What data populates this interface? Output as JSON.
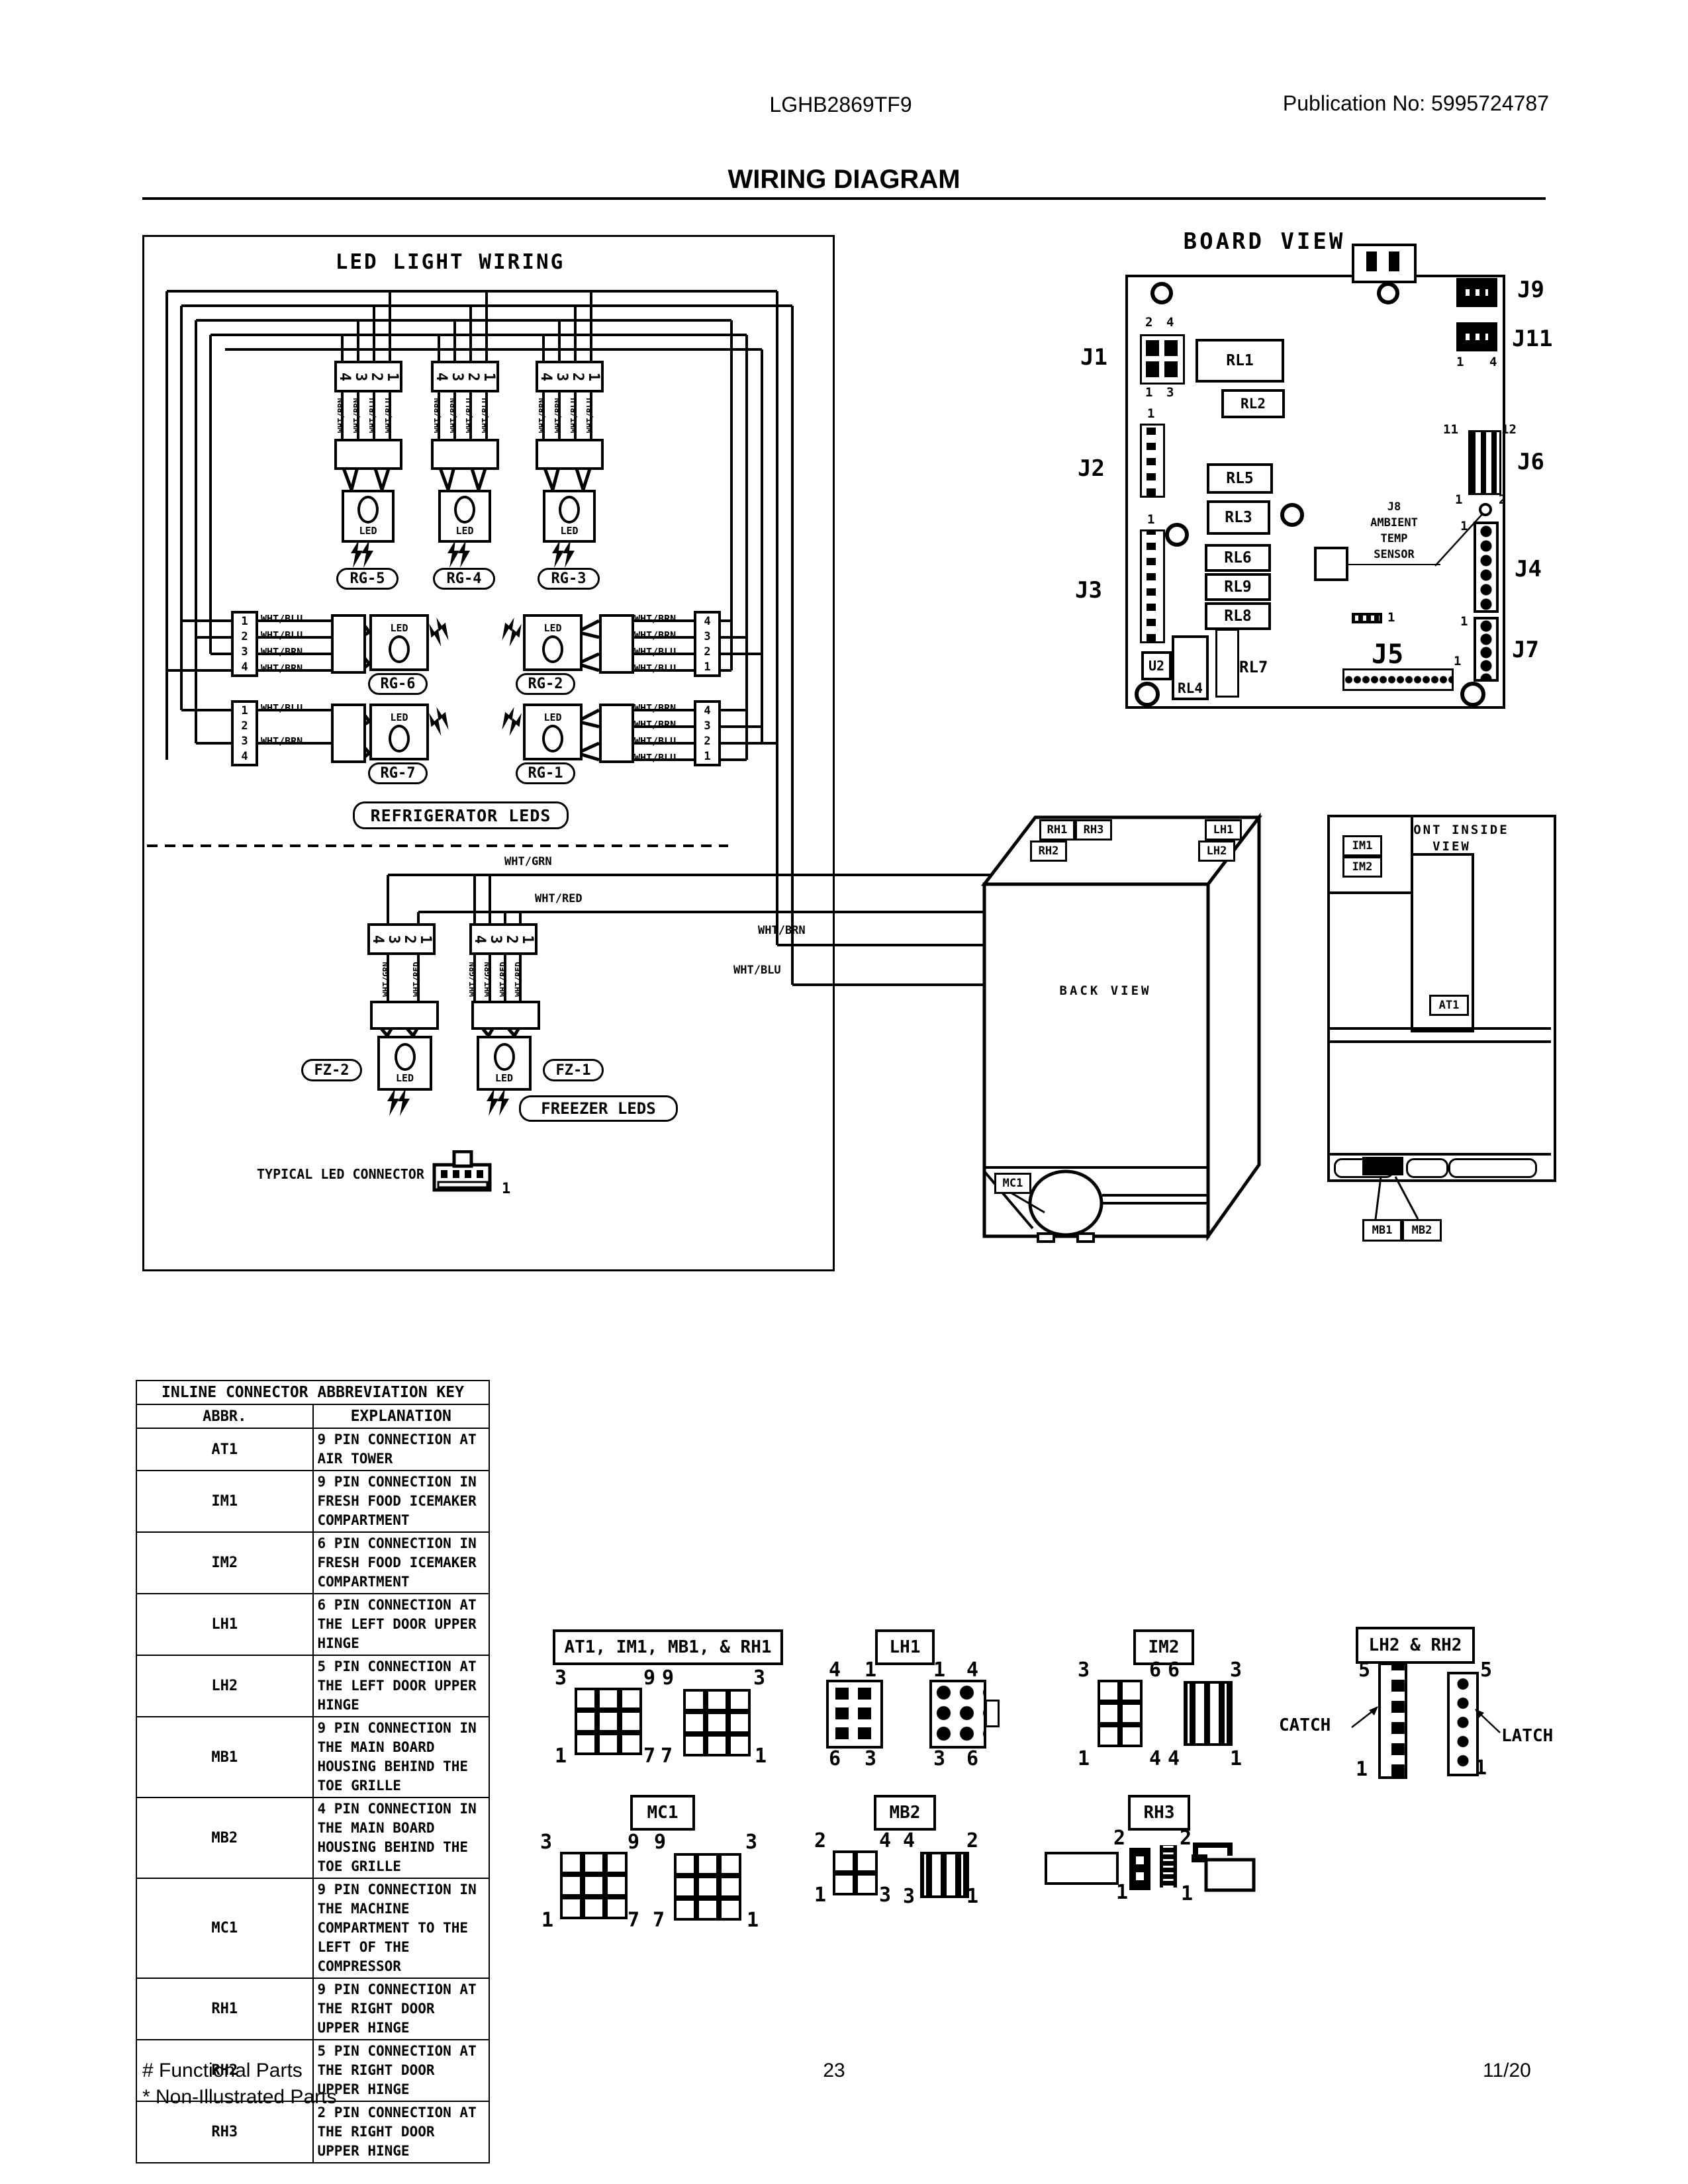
{
  "page": {
    "model": "LGHB2869TF9",
    "publication": "Publication No:  5995724787",
    "title": "WIRING DIAGRAM",
    "footer": {
      "line1": "# Functional Parts",
      "line2": "* Non-Illustrated Parts",
      "page": "23",
      "date": "11/20"
    }
  },
  "led": {
    "title": "LED LIGHT WIRING",
    "led_text": "LED",
    "refrigerator_label": "REFRIGERATOR LEDS",
    "freezer_label": "FREEZER LEDS",
    "typical": {
      "label": "TYPICAL LED CONNECTOR",
      "pin": "1"
    },
    "bus": {
      "wht_grn": "WHT/GRN",
      "wht_red": "WHT/RED",
      "wht_brn": "WHT/BRN",
      "wht_blu": "WHT/BLU"
    },
    "groups_top": [
      {
        "name": "RG-5",
        "pins": [
          "4",
          "3",
          "2",
          "1"
        ],
        "wires": [
          "WHT/BRN",
          "WHT/BRN",
          "WHT/BLU",
          "WHT/BLU"
        ]
      },
      {
        "name": "RG-4",
        "pins": [
          "4",
          "3",
          "2",
          "1"
        ],
        "wires": [
          "WHT/BRN",
          "WHT/BRN",
          "WHT/BLU",
          "WHT/BLU"
        ]
      },
      {
        "name": "RG-3",
        "pins": [
          "4",
          "3",
          "2",
          "1"
        ],
        "wires": [
          "WHT/BRN",
          "WHT/BRN",
          "WHT/BLU",
          "WHT/BLU"
        ]
      }
    ],
    "groups_left": [
      {
        "name": "RG-6",
        "pins": [
          "1",
          "2",
          "3",
          "4"
        ],
        "wires": [
          "WHT/BLU",
          "WHT/BLU",
          "WHT/BRN",
          "WHT/BRN"
        ]
      },
      {
        "name": "RG-7",
        "pins": [
          "1",
          "2",
          "3",
          "4"
        ],
        "wires": [
          "WHT/BLU",
          "",
          "WHT/BRN",
          ""
        ]
      }
    ],
    "groups_right": [
      {
        "name": "RG-2",
        "pins": [
          "4",
          "3",
          "2",
          "1"
        ],
        "wires": [
          "WHT/BRN",
          "WHT/BRN",
          "WHT/BLU",
          "WHT/BLU"
        ]
      },
      {
        "name": "RG-1",
        "pins": [
          "4",
          "3",
          "2",
          "1"
        ],
        "wires": [
          "WHT/BRN",
          "WHT/BRN",
          "WHT/BLU",
          "WHT/BLU"
        ]
      }
    ],
    "groups_fz": [
      {
        "name": "FZ-2",
        "pins": [
          "4",
          "3",
          "2",
          "1"
        ],
        "wires": [
          "",
          "WHT/GRN",
          "",
          "WHT/RED"
        ]
      },
      {
        "name": "FZ-1",
        "pins": [
          "4",
          "3",
          "2",
          "1"
        ],
        "wires": [
          "WHT/GRN",
          "WHT/GRN",
          "WHT/RED",
          "WHT/RED"
        ]
      }
    ]
  },
  "board": {
    "title": "BOARD VIEW",
    "j1": {
      "label": "J1",
      "p2": "2",
      "p4": "4",
      "p1": "1",
      "p3": "3"
    },
    "j2": {
      "label": "J2",
      "pin": "1"
    },
    "j3": {
      "label": "J3",
      "pin": "1"
    },
    "j9": {
      "label": "J9"
    },
    "j11": {
      "label": "J11",
      "left": "1",
      "right": "4"
    },
    "j6": {
      "label": "J6",
      "tl": "11",
      "tr": "12",
      "bl": "1",
      "br": "2"
    },
    "j4": {
      "label": "J4",
      "pin": "1"
    },
    "j7": {
      "label": "J7",
      "pin": "1"
    },
    "j5": {
      "label": "J5",
      "pin": "1"
    },
    "j8": {
      "line1": "J8",
      "line2": "AMBIENT",
      "line3": "TEMP",
      "line4": "SENSOR"
    },
    "relays": {
      "rl1": "RL1",
      "rl2": "RL2",
      "rl5": "RL5",
      "rl3": "RL3",
      "rl6": "RL6",
      "rl9": "RL9",
      "rl8": "RL8",
      "rl4": "RL4",
      "rl7": "RL7",
      "u2": "U2"
    },
    "center_pin": "1"
  },
  "back": {
    "title": "BACK VIEW",
    "rh1": "RH1",
    "rh3": "RH3",
    "rh2": "RH2",
    "lh1": "LH1",
    "lh2": "LH2",
    "mc1": "MC1"
  },
  "front": {
    "line1": "FRONT INSIDE",
    "line2": "VIEW",
    "im1": "IM1",
    "im2": "IM2",
    "at1": "AT1",
    "mb1": "MB1",
    "mb2": "MB2"
  },
  "key_table": {
    "title": "INLINE CONNECTOR ABBREVIATION KEY",
    "col_abbr": "ABBR.",
    "col_expl": "EXPLANATION",
    "rows": [
      {
        "abbr": "AT1",
        "text": "9 PIN CONNECTION AT AIR TOWER"
      },
      {
        "abbr": "IM1",
        "text": "9 PIN CONNECTION IN FRESH FOOD ICEMAKER COMPARTMENT"
      },
      {
        "abbr": "IM2",
        "text": "6 PIN CONNECTION IN FRESH FOOD ICEMAKER COMPARTMENT"
      },
      {
        "abbr": "LH1",
        "text": "6 PIN CONNECTION AT THE LEFT DOOR UPPER HINGE"
      },
      {
        "abbr": "LH2",
        "text": "5 PIN CONNECTION AT THE LEFT DOOR UPPER HINGE"
      },
      {
        "abbr": "MB1",
        "text": "9 PIN CONNECTION IN THE MAIN BOARD HOUSING BEHIND THE TOE GRILLE"
      },
      {
        "abbr": "MB2",
        "text": "4 PIN CONNECTION IN THE MAIN BOARD HOUSING BEHIND THE TOE GRILLE"
      },
      {
        "abbr": "MC1",
        "text": "9 PIN CONNECTION IN THE MACHINE COMPARTMENT TO THE LEFT OF THE COMPRESSOR"
      },
      {
        "abbr": "RH1",
        "text": "9 PIN CONNECTION AT THE RIGHT DOOR UPPER HINGE"
      },
      {
        "abbr": "RH2",
        "text": "5 PIN CONNECTION AT THE RIGHT DOOR UPPER HINGE"
      },
      {
        "abbr": "RH3",
        "text": "2 PIN CONNECTION AT THE RIGHT DOOR UPPER HINGE"
      }
    ]
  },
  "pinouts": {
    "g1": {
      "label": "AT1, IM1, MB1, & RH1",
      "L": {
        "tl": "3",
        "tr": "9",
        "bl": "1",
        "br": "7"
      },
      "R": {
        "tl": "9",
        "tr": "3",
        "bl": "7",
        "br": "1"
      }
    },
    "lh1": {
      "label": "LH1",
      "L": {
        "tl": "4",
        "tr": "1",
        "bl": "6",
        "br": "3"
      },
      "R": {
        "tl": "1",
        "tr": "4",
        "bl": "3",
        "br": "6"
      }
    },
    "im2": {
      "label": "IM2",
      "L": {
        "tl": "3",
        "tr": "6",
        "bl": "1",
        "br": "4"
      },
      "R": {
        "tl": "6",
        "tr": "3",
        "bl": "4",
        "br": "1"
      }
    },
    "lh2rh2": {
      "label": "LH2 & RH2",
      "catch": "CATCH",
      "latch": "LATCH",
      "L": {
        "top": "5",
        "bottom": "1"
      },
      "R": {
        "top": "5",
        "bottom": "1"
      }
    },
    "mc1": {
      "label": "MC1",
      "L": {
        "tl": "3",
        "tr": "9",
        "bl": "1",
        "br": "7"
      },
      "R": {
        "tl": "9",
        "tr": "3",
        "bl": "7",
        "br": "1"
      }
    },
    "mb2": {
      "label": "MB2",
      "L": {
        "tl": "2",
        "tr": "4",
        "bl": "1",
        "br": "3"
      },
      "R": {
        "tl": "4",
        "tr": "2",
        "bl": "3",
        "br": "1"
      }
    },
    "rh3": {
      "label": "RH3",
      "a": {
        "top": "2",
        "bottom": "1"
      },
      "b": {
        "top": "2",
        "bottom": "1"
      }
    }
  }
}
